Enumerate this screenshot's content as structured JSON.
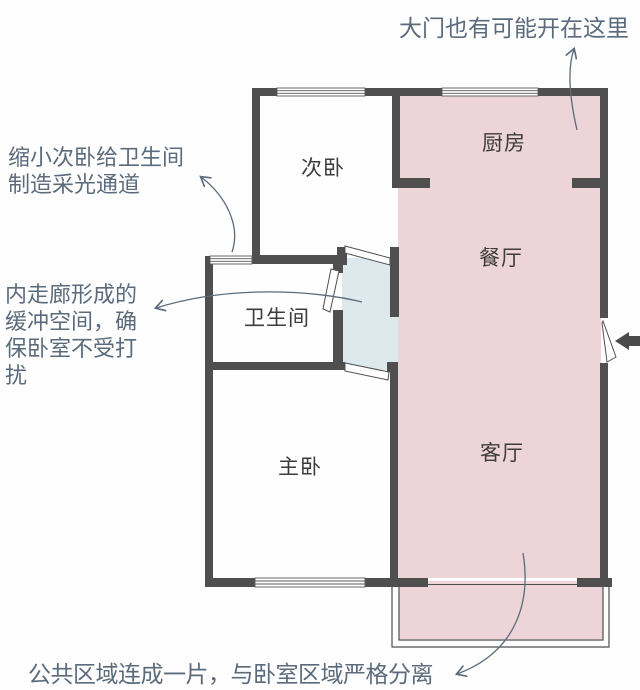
{
  "title": "户型图示意",
  "rooms": [
    {
      "name": "secondary-bedroom",
      "label": "次卧"
    },
    {
      "name": "kitchen",
      "label": "厨房"
    },
    {
      "name": "dining-room",
      "label": "餐厅"
    },
    {
      "name": "bathroom",
      "label": "卫生间"
    },
    {
      "name": "master-bedroom",
      "label": "主卧"
    },
    {
      "name": "living-room",
      "label": "客厅"
    }
  ],
  "annotations": {
    "top_right": "大门也有可能开在这里",
    "left_top_line1": "缩小次卧给卫生间",
    "left_top_line2": "制造采光通道",
    "left_mid_line1": "内走廊形成的",
    "left_mid_line2": "缓冲空间，确",
    "left_mid_line3": "保卧室不受打",
    "left_mid_line4": "扰",
    "bottom": "公共区域连成一片，与卧室区域严格分离"
  },
  "legend_colors": {
    "public_zone_fill": "#ecd4d9",
    "corridor_lightshaft_fill": "#dde9ec",
    "wall": "#4f4f4f",
    "annotation_ink": "#5b6b7c",
    "room_label_ink": "#3c3c3c",
    "entry_arrow": "#4a4a4a"
  },
  "icons": {
    "entry_arrow": "left-arrow",
    "callout_arrowhead": "open-v-arrowhead"
  }
}
